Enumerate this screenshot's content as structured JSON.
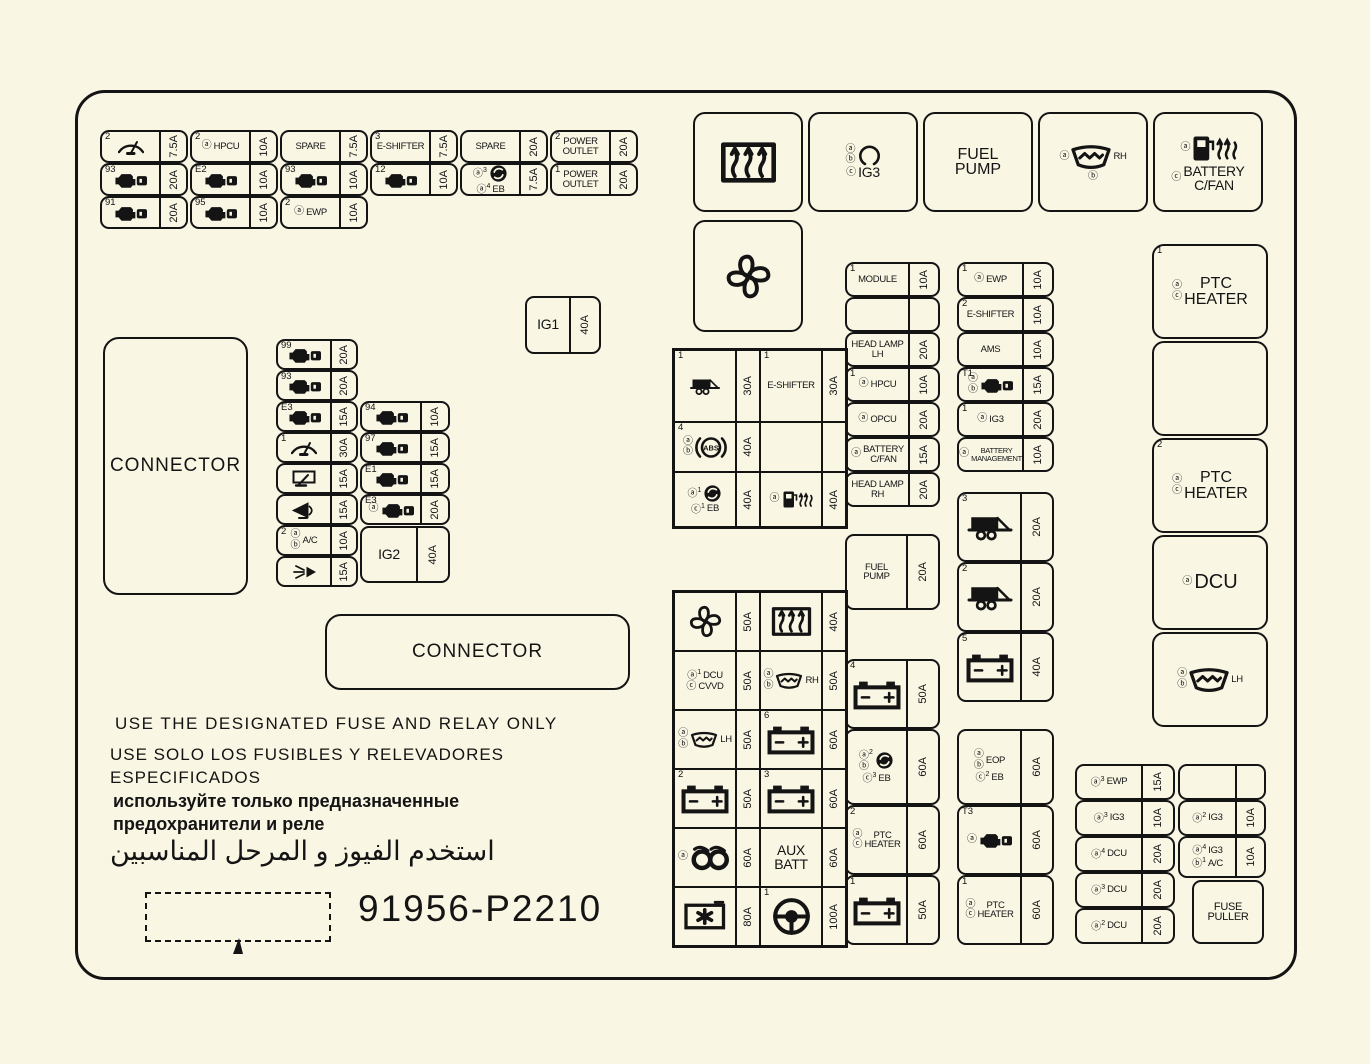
{
  "colors": {
    "background": "#f9f6e4",
    "ink": "#141414"
  },
  "footer": {
    "warning_en": "USE THE DESIGNATED FUSE AND RELAY ONLY",
    "warning_es": "USE SOLO LOS FUSIBLES Y RELEVADORES\nESPECIFICADOS",
    "warning_ru": "используйте только предназначенные\nпредохранители и реле",
    "warning_ar": "استخدم الفيوز و المرحل المناسبين",
    "part_number": "91956-P2210"
  },
  "blocks": {
    "topLeftGrid": {
      "kind": "fuses",
      "cells": [
        {
          "sup": "2",
          "icon": "wiper",
          "amp": "7.5A"
        },
        {
          "sup": "2",
          "marks": [
            "a"
          ],
          "text": "HPCU",
          "amp": "10A"
        },
        {
          "text": "SPARE",
          "amp": "7.5A"
        },
        {
          "sup": "3",
          "text": "E-SHIFTER",
          "amp": "7.5A"
        },
        {
          "text": "SPARE",
          "amp": "20A"
        },
        {
          "sup": "2",
          "text": "POWER\nOUTLET",
          "amp": "20A"
        },
        {
          "sup": "93",
          "icon": "engine",
          "amp": "20A"
        },
        {
          "sup": "E2",
          "icon": "engine",
          "amp": "10A"
        },
        {
          "sup": "93",
          "icon": "engine",
          "amp": "10A"
        },
        {
          "sup": "12",
          "icon": "engine",
          "amp": "10A"
        },
        {
          "lines": [
            {
              "marks": [
                "a3"
              ],
              "icon": "motor"
            },
            {
              "marks": [
                "a4"
              ],
              "text": "EB"
            }
          ],
          "amp": "7.5A"
        },
        {
          "sup": "1",
          "text": "POWER\nOUTLET",
          "amp": "20A"
        },
        {
          "sup": "91",
          "icon": "engine",
          "amp": "20A"
        },
        {
          "sup": "95",
          "icon": "engine",
          "amp": "10A"
        },
        {
          "sup": "2",
          "marks": [
            "a"
          ],
          "text": "EWP",
          "amp": "10A"
        },
        null,
        null,
        null
      ]
    },
    "ig1": {
      "kind": "fuses",
      "cells": [
        {
          "text": "IG1",
          "lcls": "b1",
          "amp": "40A"
        }
      ]
    },
    "connectorLeft": {
      "kind": "fuses",
      "cells": [
        {
          "text": "CONNECTOR",
          "lcls": "conn"
        }
      ]
    },
    "midLeftColA": {
      "kind": "fuses",
      "cells": [
        {
          "sup": "99",
          "icon": "engine",
          "amp": "20A"
        },
        {
          "sup": "93",
          "icon": "engine",
          "amp": "20A"
        },
        {
          "sup": "E3",
          "icon": "engine",
          "amp": "15A"
        },
        {
          "sup": "1",
          "icon": "wiper",
          "amp": "30A"
        },
        {
          "icon": "wiper-rear",
          "amp": "15A"
        },
        {
          "icon": "horn",
          "amp": "15A"
        },
        {
          "sup": "2",
          "marks": [
            "a",
            "b"
          ],
          "text": "A/C",
          "amp": "10A"
        },
        {
          "icon": "spray",
          "amp": "15A"
        }
      ]
    },
    "midLeftColB": {
      "kind": "fuses",
      "cells": [
        {
          "sup": "94",
          "icon": "engine",
          "amp": "10A"
        },
        {
          "sup": "97",
          "icon": "engine",
          "amp": "15A"
        },
        {
          "sup": "E1",
          "icon": "engine",
          "amp": "15A"
        },
        {
          "sup": "E3",
          "marks": [
            "a"
          ],
          "icon": "engine",
          "amp": "20A"
        }
      ]
    },
    "ig2": {
      "kind": "fuses",
      "cells": [
        {
          "text": "IG2",
          "lcls": "b1",
          "amp": "40A"
        }
      ]
    },
    "connectorBottom": {
      "kind": "fuses",
      "cells": [
        {
          "text": "CONNECTOR",
          "lcls": "conn"
        }
      ]
    },
    "topRelays": {
      "kind": "fuses",
      "cells": [
        {
          "lines": [
            {
              "icon": "defrost",
              "cls": "xl"
            }
          ]
        },
        {
          "lines": [
            {
              "marks": [
                "a",
                "b"
              ],
              "icon": "relay-coil"
            },
            {
              "marks": [
                "c"
              ],
              "text": "IG3",
              "cls": "b1"
            }
          ]
        },
        {
          "lines": [
            {
              "text": "FUEL\nPUMP",
              "cls": "b2"
            }
          ]
        },
        {
          "lines": [
            {
              "marks": [
                "a"
              ],
              "text": "RH",
              "icon": "washer",
              "cls": "lg"
            },
            {
              "marks": [
                "b"
              ]
            }
          ]
        },
        {
          "lines": [
            {
              "marks": [
                "a"
              ],
              "icon": "fuel-heater",
              "cls": "lg"
            },
            {
              "marks": [
                "c"
              ],
              "text": "BATTERY\nC/FAN",
              "cls": "b1"
            }
          ]
        }
      ]
    },
    "fanRelay": {
      "kind": "fuses",
      "cells": [
        {
          "lines": [
            {
              "icon": "fan",
              "cls": "xl"
            }
          ]
        }
      ]
    },
    "midTable": {
      "kind": "table",
      "cells": [
        {
          "sup": "1",
          "icon": "trailer",
          "amp": "30A"
        },
        {
          "sup": "1",
          "text": "E-SHIFTER",
          "amp": "30A"
        },
        {
          "sup": "4",
          "lines": [
            {
              "marks": [
                "a",
                "b"
              ],
              "icon": "abs"
            }
          ],
          "amp": "40A"
        },
        {
          "amp": ""
        },
        {
          "lines": [
            {
              "marks": [
                "a1"
              ],
              "icon": "motor"
            },
            {
              "marks": [
                "c1"
              ],
              "text": "EB"
            }
          ],
          "amp": "40A"
        },
        {
          "lines": [
            {
              "marks": [
                "a"
              ],
              "icon": "fuel-heater"
            }
          ],
          "amp": "40A"
        }
      ]
    },
    "colB": {
      "kind": "fuses",
      "cells": [
        {
          "sup": "1",
          "text": "MODULE",
          "amp": "10A"
        },
        {
          "amp": ""
        },
        {
          "text": "HEAD LAMP\nLH",
          "amp": "20A"
        },
        {
          "sup": "1",
          "marks": [
            "a"
          ],
          "text": "HPCU",
          "amp": "10A"
        },
        {
          "marks": [
            "a"
          ],
          "text": "OPCU",
          "amp": "20A"
        },
        {
          "marks": [
            "a"
          ],
          "text": "BATTERY\nC/FAN",
          "amp": "15A"
        },
        {
          "text": "HEAD LAMP\nRH",
          "amp": "20A"
        }
      ]
    },
    "colC": {
      "kind": "fuses",
      "cells": [
        {
          "sup": "1",
          "marks": [
            "a"
          ],
          "text": "EWP",
          "amp": "10A"
        },
        {
          "sup": "2",
          "text": "E-SHIFTER",
          "amp": "10A"
        },
        {
          "text": "AMS",
          "amp": "10A"
        },
        {
          "sup": "T1",
          "marks": [
            "a",
            "b"
          ],
          "icon": "engine",
          "amp": "15A"
        },
        {
          "sup": "1",
          "marks": [
            "a"
          ],
          "text": "IG3",
          "amp": "20A"
        },
        {
          "marks": [
            "a"
          ],
          "text": "BATTERY\nMANAGEMENT",
          "lcls": "sm",
          "amp": "10A"
        }
      ]
    },
    "fuelPumpFuse": {
      "kind": "fuses",
      "cells": [
        {
          "text": "FUEL\nPUMP",
          "amp": "20A"
        }
      ]
    },
    "colC2": {
      "kind": "fuses",
      "cells": [
        {
          "sup": "3",
          "icon": "trailer",
          "lcls": "lg",
          "amp": "20A"
        },
        {
          "sup": "2",
          "icon": "trailer",
          "lcls": "lg",
          "amp": "20A"
        },
        {
          "sup": "5",
          "icon": "battery",
          "lcls": "lg",
          "amp": "40A"
        }
      ]
    },
    "bottomTable": {
      "kind": "table",
      "cells": [
        {
          "icon": "fan",
          "lcls": "lg",
          "amp": "50A"
        },
        {
          "icon": "defrost",
          "lcls": "lg",
          "amp": "40A"
        },
        {
          "lines": [
            {
              "marks": [
                "a1"
              ],
              "text": "DCU"
            },
            {
              "marks": [
                "c"
              ],
              "text": "CVVD"
            }
          ],
          "amp": "50A"
        },
        {
          "lines": [
            {
              "marks": [
                "a",
                "b"
              ],
              "text": "RH",
              "icon": "washer"
            }
          ],
          "amp": "50A"
        },
        {
          "lines": [
            {
              "marks": [
                "a",
                "b"
              ],
              "text": "LH",
              "icon": "washer"
            }
          ],
          "amp": "50A"
        },
        {
          "sup": "6",
          "icon": "battery",
          "lcls": "lg",
          "amp": "60A"
        },
        {
          "sup": "2",
          "icon": "battery",
          "lcls": "lg",
          "amp": "50A"
        },
        {
          "sup": "3",
          "icon": "battery",
          "lcls": "lg",
          "amp": "60A"
        },
        {
          "lines": [
            {
              "marks": [
                "a"
              ],
              "icon": "coil",
              "cls": "lg"
            }
          ],
          "amp": "60A"
        },
        {
          "text": "AUX\nBATT",
          "lcls": "b1",
          "amp": "60A"
        },
        {
          "icon": "accomp",
          "lcls": "lg",
          "amp": "80A"
        },
        {
          "sup": "1",
          "icon": "steering",
          "lcls": "lg",
          "amp": "100A"
        }
      ]
    },
    "colE": {
      "kind": "fuses",
      "cells": [
        {
          "sup": "4",
          "icon": "battery",
          "lcls": "lg",
          "amp": "50A"
        },
        {
          "lines": [
            {
              "marks": [
                "a2",
                "b"
              ],
              "icon": "motor"
            },
            {
              "marks": [
                "c3"
              ],
              "text": "EB"
            }
          ],
          "amp": "60A"
        },
        {
          "sup": "2",
          "marks": [
            "a",
            "c"
          ],
          "text": "PTC\nHEATER",
          "amp": "60A"
        },
        {
          "sup": "1",
          "icon": "battery",
          "lcls": "lg",
          "amp": "50A"
        }
      ]
    },
    "colF": {
      "kind": "fuses",
      "cells": [
        {
          "lines": [
            {
              "marks": [
                "a",
                "b"
              ],
              "text": "EOP"
            },
            {
              "marks": [
                "c2"
              ],
              "text": "EB"
            }
          ],
          "amp": "60A"
        },
        {
          "sup": "T3",
          "marks": [
            "a"
          ],
          "icon": "engine",
          "amp": "60A"
        },
        {
          "sup": "1",
          "marks": [
            "a",
            "c"
          ],
          "text": "PTC\nHEATER",
          "amp": "60A"
        }
      ]
    },
    "rightCol": {
      "kind": "fuses",
      "cells": [
        {
          "sup": "1",
          "marks": [
            "a",
            "c"
          ],
          "text": "PTC\nHEATER",
          "lcls": "b2"
        },
        {},
        {
          "sup": "2",
          "marks": [
            "a",
            "c"
          ],
          "text": "PTC\nHEATER",
          "lcls": "b2"
        },
        {
          "marks": [
            "a"
          ],
          "text": "DCU",
          "lcls": "b3"
        },
        {
          "lines": [
            {
              "marks": [
                "a",
                "b"
              ],
              "text": "LH",
              "icon": "washer",
              "cls": "lg"
            }
          ]
        }
      ]
    },
    "colG": {
      "kind": "fuses",
      "cells": [
        {
          "marks": [
            "a3"
          ],
          "text": "EWP",
          "amp": "15A"
        },
        {
          "marks": [
            "a3"
          ],
          "text": "IG3",
          "amp": "10A"
        },
        {
          "marks": [
            "a4"
          ],
          "text": "DCU",
          "amp": "20A"
        },
        {
          "marks": [
            "a3"
          ],
          "text": "DCU",
          "amp": "20A"
        },
        {
          "marks": [
            "a2"
          ],
          "text": "DCU",
          "amp": "20A"
        }
      ]
    },
    "colH": {
      "kind": "fuses",
      "cells": [
        {
          "amp": ""
        },
        {
          "marks": [
            "a2"
          ],
          "text": "IG3",
          "amp": "10A"
        },
        {
          "lines": [
            {
              "marks": [
                "a4"
              ],
              "text": "IG3"
            },
            {
              "marks": [
                "b1"
              ],
              "text": "A/C"
            }
          ],
          "amp": "10A"
        }
      ]
    },
    "fusePuller": {
      "kind": "fuses",
      "cells": [
        {
          "text": "FUSE\nPULLER",
          "lcls": "fp"
        }
      ]
    }
  }
}
